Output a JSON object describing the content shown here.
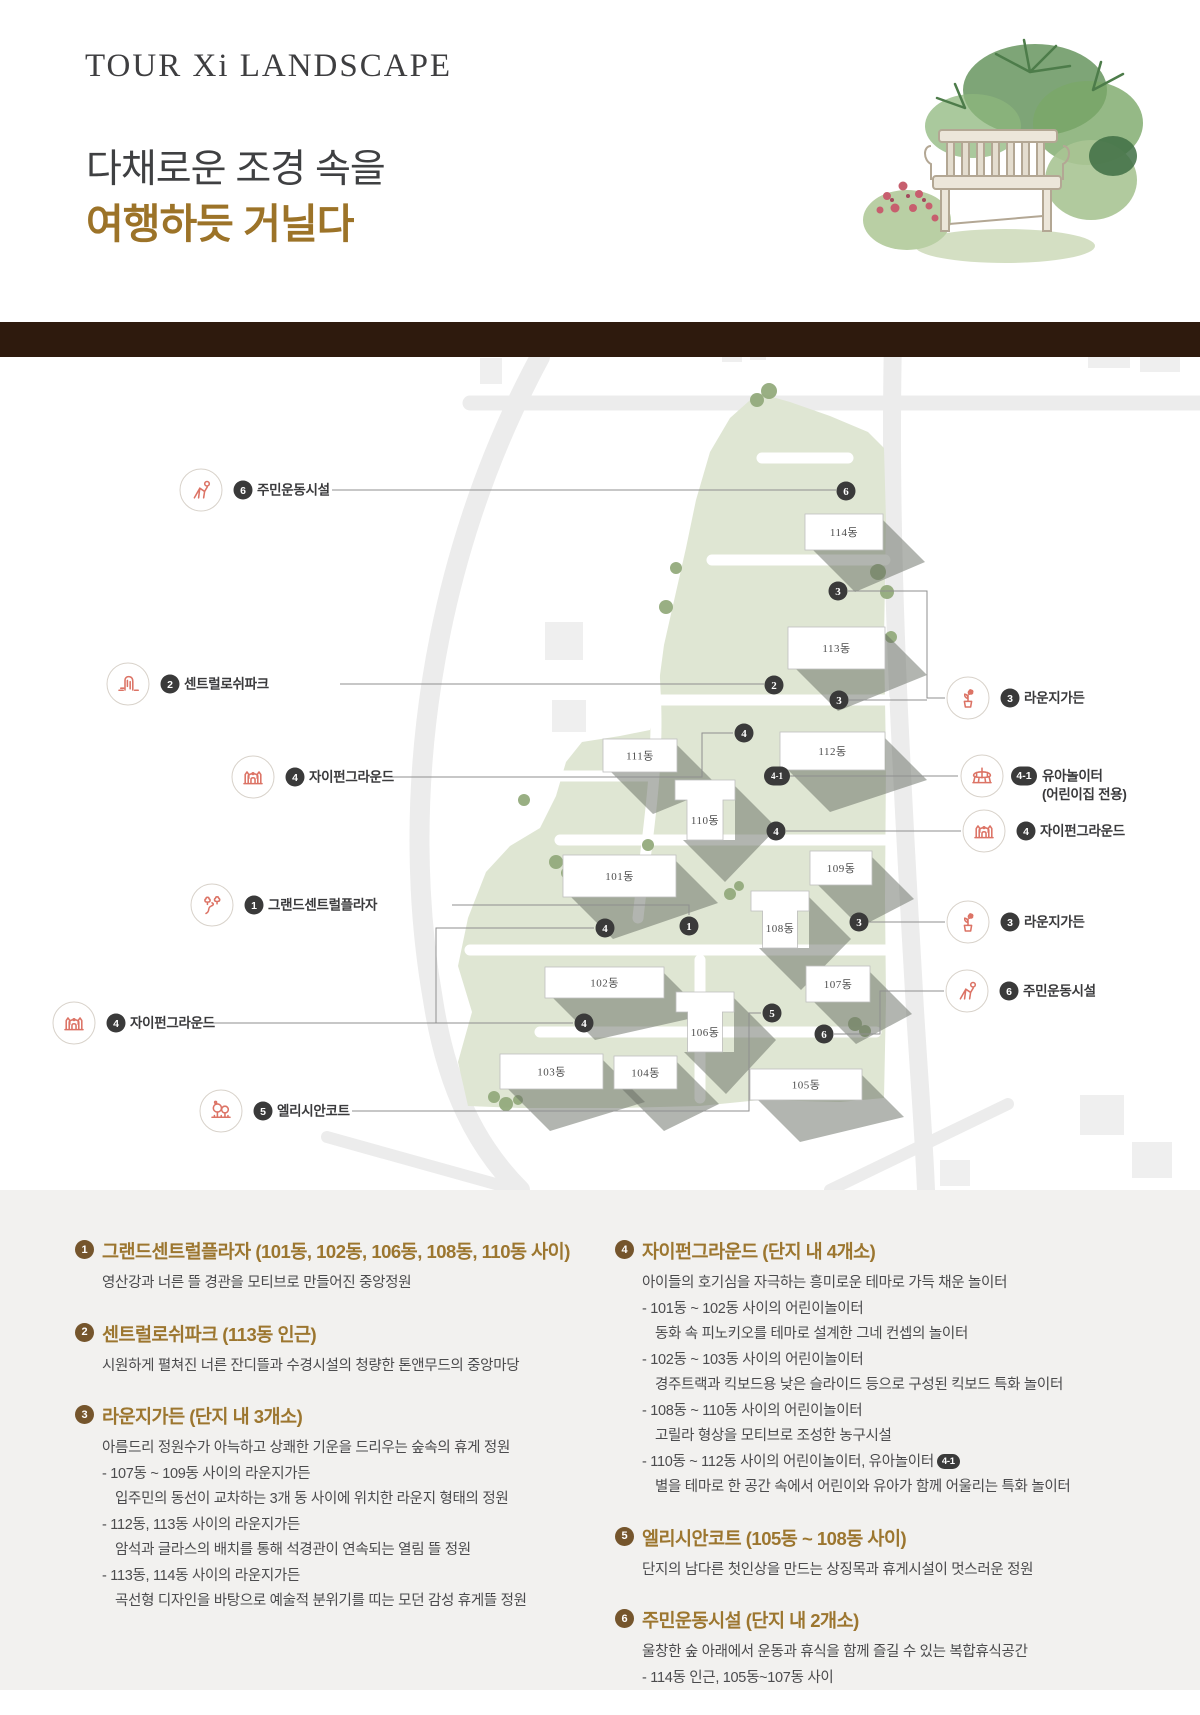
{
  "header": {
    "title": "TOUR Xi LANDSCAPE",
    "subtitle_line1": "다채로운 조경 속을",
    "subtitle_line2": "여행하듯 거닐다"
  },
  "colors": {
    "accent_gold": "#9c762f",
    "band_brown": "#2e1a0d",
    "site_green": "#dfe6d3",
    "tree_green": "#94ab7d",
    "icon_coral": "#dc7365",
    "dot_dark": "#3a3a3a",
    "legend_bg": "#f2f1ef",
    "legend_badge_brown": "#75552c"
  },
  "map": {
    "buildings": [
      {
        "label": "114동",
        "shape": "rect",
        "x": 805,
        "y": 514,
        "w": 78,
        "h": 36
      },
      {
        "label": "113동",
        "shape": "rect",
        "x": 788,
        "y": 627,
        "w": 97,
        "h": 42
      },
      {
        "label": "112동",
        "shape": "rect",
        "x": 780,
        "y": 732,
        "w": 105,
        "h": 38
      },
      {
        "label": "111동",
        "shape": "rect",
        "x": 603,
        "y": 739,
        "w": 74,
        "h": 33
      },
      {
        "label": "110동",
        "shape": "tee",
        "x": 675,
        "y": 780,
        "w": 60,
        "h": 60
      },
      {
        "label": "109동",
        "shape": "rect",
        "x": 810,
        "y": 851,
        "w": 62,
        "h": 34
      },
      {
        "label": "101동",
        "shape": "rect",
        "x": 563,
        "y": 855,
        "w": 113,
        "h": 42
      },
      {
        "label": "108동",
        "shape": "tee",
        "x": 751,
        "y": 891,
        "w": 58,
        "h": 57
      },
      {
        "label": "102동",
        "shape": "rect",
        "x": 545,
        "y": 967,
        "w": 119,
        "h": 31
      },
      {
        "label": "107동",
        "shape": "rect",
        "x": 806,
        "y": 966,
        "w": 64,
        "h": 36
      },
      {
        "label": "106동",
        "shape": "tee",
        "x": 676,
        "y": 992,
        "w": 58,
        "h": 60
      },
      {
        "label": "103동",
        "shape": "rect",
        "x": 500,
        "y": 1054,
        "w": 103,
        "h": 35
      },
      {
        "label": "104동",
        "shape": "rect",
        "x": 614,
        "y": 1056,
        "w": 63,
        "h": 33
      },
      {
        "label": "105동",
        "shape": "rect",
        "x": 750,
        "y": 1069,
        "w": 112,
        "h": 31
      }
    ],
    "dots": [
      {
        "n": "6",
        "x": 846,
        "y": 491
      },
      {
        "n": "3",
        "x": 838,
        "y": 591
      },
      {
        "n": "2",
        "x": 774,
        "y": 685
      },
      {
        "n": "3",
        "x": 839,
        "y": 700
      },
      {
        "n": "4",
        "x": 744,
        "y": 733
      },
      {
        "n": "4-1",
        "x": 777,
        "y": 776
      },
      {
        "n": "4",
        "x": 776,
        "y": 831
      },
      {
        "n": "4",
        "x": 605,
        "y": 928
      },
      {
        "n": "1",
        "x": 689,
        "y": 926
      },
      {
        "n": "3",
        "x": 859,
        "y": 922
      },
      {
        "n": "5",
        "x": 772,
        "y": 1013
      },
      {
        "n": "4",
        "x": 584,
        "y": 1023
      },
      {
        "n": "6",
        "x": 824,
        "y": 1034
      }
    ],
    "leaders": [
      [
        [
          332,
          490
        ],
        [
          836,
          490
        ]
      ],
      [
        [
          340,
          684
        ],
        [
          764,
          684
        ]
      ],
      [
        [
          390,
          777
        ],
        [
          702,
          777
        ],
        [
          702,
          733
        ],
        [
          733,
          733
        ]
      ],
      [
        [
          452,
          905
        ],
        [
          689,
          905
        ],
        [
          689,
          915
        ]
      ],
      [
        [
          192,
          1023
        ],
        [
          573,
          1023
        ]
      ],
      [
        [
          436,
          1023
        ],
        [
          436,
          928
        ],
        [
          594,
          928
        ]
      ],
      [
        [
          352,
          1111
        ],
        [
          749,
          1111
        ],
        [
          749,
          1013
        ],
        [
          761,
          1013
        ]
      ],
      [
        [
          848,
          591
        ],
        [
          927,
          591
        ],
        [
          927,
          698
        ],
        [
          945,
          698
        ]
      ],
      [
        [
          849,
          700
        ],
        [
          927,
          700
        ]
      ],
      [
        [
          787,
          776
        ],
        [
          958,
          776
        ]
      ],
      [
        [
          786,
          831
        ],
        [
          961,
          831
        ]
      ],
      [
        [
          869,
          922
        ],
        [
          945,
          922
        ]
      ],
      [
        [
          834,
          1034
        ],
        [
          880,
          1034
        ],
        [
          880,
          991
        ],
        [
          944,
          991
        ]
      ]
    ],
    "callouts": [
      {
        "icon": "exercise-icon",
        "num": "6",
        "label": "주민운동시설",
        "cx": 201,
        "cy": 490
      },
      {
        "icon": "waterfall-icon",
        "num": "2",
        "label": "센트럴로쉬파크",
        "cx": 128,
        "cy": 684
      },
      {
        "icon": "bouncy-castle-icon",
        "num": "4",
        "label": "자이펀그라운드",
        "cx": 253,
        "cy": 777
      },
      {
        "icon": "trees-path-icon",
        "num": "1",
        "label": "그랜드센트럴플라자",
        "cx": 212,
        "cy": 905
      },
      {
        "icon": "bouncy-castle-icon",
        "num": "4",
        "label": "자이펀그라운드",
        "cx": 74,
        "cy": 1023
      },
      {
        "icon": "garden-trees-icon",
        "num": "5",
        "label": "엘리시안코트",
        "cx": 221,
        "cy": 1111
      },
      {
        "icon": "flower-pot-icon",
        "num": "3",
        "label": "라운지가든",
        "cx": 968,
        "cy": 698
      },
      {
        "icon": "carousel-icon",
        "num": "4-1",
        "label": "유아놀이터",
        "label2": "(어린이집 전용)",
        "cx": 982,
        "cy": 776
      },
      {
        "icon": "bouncy-castle-icon",
        "num": "4",
        "label": "자이펀그라운드",
        "cx": 984,
        "cy": 831
      },
      {
        "icon": "flower-pot-icon",
        "num": "3",
        "label": "라운지가든",
        "cx": 968,
        "cy": 922
      },
      {
        "icon": "exercise-icon",
        "num": "6",
        "label": "주민운동시설",
        "cx": 967,
        "cy": 991
      }
    ]
  },
  "legend": {
    "columns": [
      {
        "items": [
          {
            "num": "1",
            "title": "그랜드센트럴플라자 (101동, 102동, 106동, 108동, 110동 사이)",
            "lines": [
              {
                "t": "영산강과 너른 뜰 경관을 모티브로 만들어진 중앙정원",
                "ind": 0
              }
            ]
          },
          {
            "num": "2",
            "title": "센트럴로쉬파크 (113동 인근)",
            "lines": [
              {
                "t": "시원하게 펼쳐진 너른 잔디뜰과 수경시설의 청량한 톤앤무드의 중앙마당",
                "ind": 0
              }
            ]
          },
          {
            "num": "3",
            "title": "라운지가든 (단지 내 3개소)",
            "lines": [
              {
                "t": "아름드리 정원수가 아늑하고 상쾌한 기운을 드리우는 숲속의 휴게 정원",
                "ind": 0
              },
              {
                "t": "- 107동 ~ 109동 사이의 라운지가든",
                "ind": 1
              },
              {
                "t": "입주민의 동선이 교차하는 3개 동 사이에 위치한 라운지 형태의 정원",
                "ind": 2
              },
              {
                "t": "- 112동, 113동 사이의 라운지가든",
                "ind": 1
              },
              {
                "t": "암석과 글라스의 배치를 통해 석경관이 연속되는 열림 뜰 정원",
                "ind": 2
              },
              {
                "t": "- 113동, 114동 사이의 라운지가든",
                "ind": 1
              },
              {
                "t": "곡선형 디자인을 바탕으로 예술적 분위기를 띠는 모던 감성 휴게뜰 정원",
                "ind": 2
              }
            ]
          }
        ]
      },
      {
        "items": [
          {
            "num": "4",
            "title": "자이펀그라운드 (단지 내 4개소)",
            "lines": [
              {
                "t": "아이들의 호기심을 자극하는 흥미로운 테마로 가득 채운 놀이터",
                "ind": 0
              },
              {
                "t": "- 101동 ~ 102동 사이의 어린이놀이터",
                "ind": 1
              },
              {
                "t": "동화 속 피노키오를 테마로 설계한 그네 컨셉의 놀이터",
                "ind": 2
              },
              {
                "t": "- 102동 ~ 103동 사이의 어린이놀이터",
                "ind": 1
              },
              {
                "t": "경주트랙과 킥보드용 낮은 슬라이드 등으로 구성된 킥보드 특화 놀이터",
                "ind": 2
              },
              {
                "t": "- 108동 ~ 110동 사이의 어린이놀이터",
                "ind": 1
              },
              {
                "t": "고릴라 형상을 모티브로 조성한 농구시설",
                "ind": 2
              },
              {
                "t": "- 110동 ~ 112동 사이의 어린이놀이터, 유아놀이터",
                "ind": 1,
                "badge": "4-1"
              },
              {
                "t": "별을 테마로 한 공간 속에서 어린이와 유아가 함께 어울리는 특화 놀이터",
                "ind": 2
              }
            ]
          },
          {
            "num": "5",
            "title": "엘리시안코트 (105동 ~ 108동 사이)",
            "lines": [
              {
                "t": "단지의 남다른 첫인상을 만드는 상징목과 휴게시설이 멋스러운 정원",
                "ind": 0
              }
            ]
          },
          {
            "num": "6",
            "title": "주민운동시설 (단지 내 2개소)",
            "lines": [
              {
                "t": "울창한 숲 아래에서 운동과 휴식을 함께 즐길 수 있는 복합휴식공간",
                "ind": 0
              },
              {
                "t": "- 114동 인근, 105동~107동 사이",
                "ind": 1
              }
            ]
          }
        ]
      }
    ]
  }
}
